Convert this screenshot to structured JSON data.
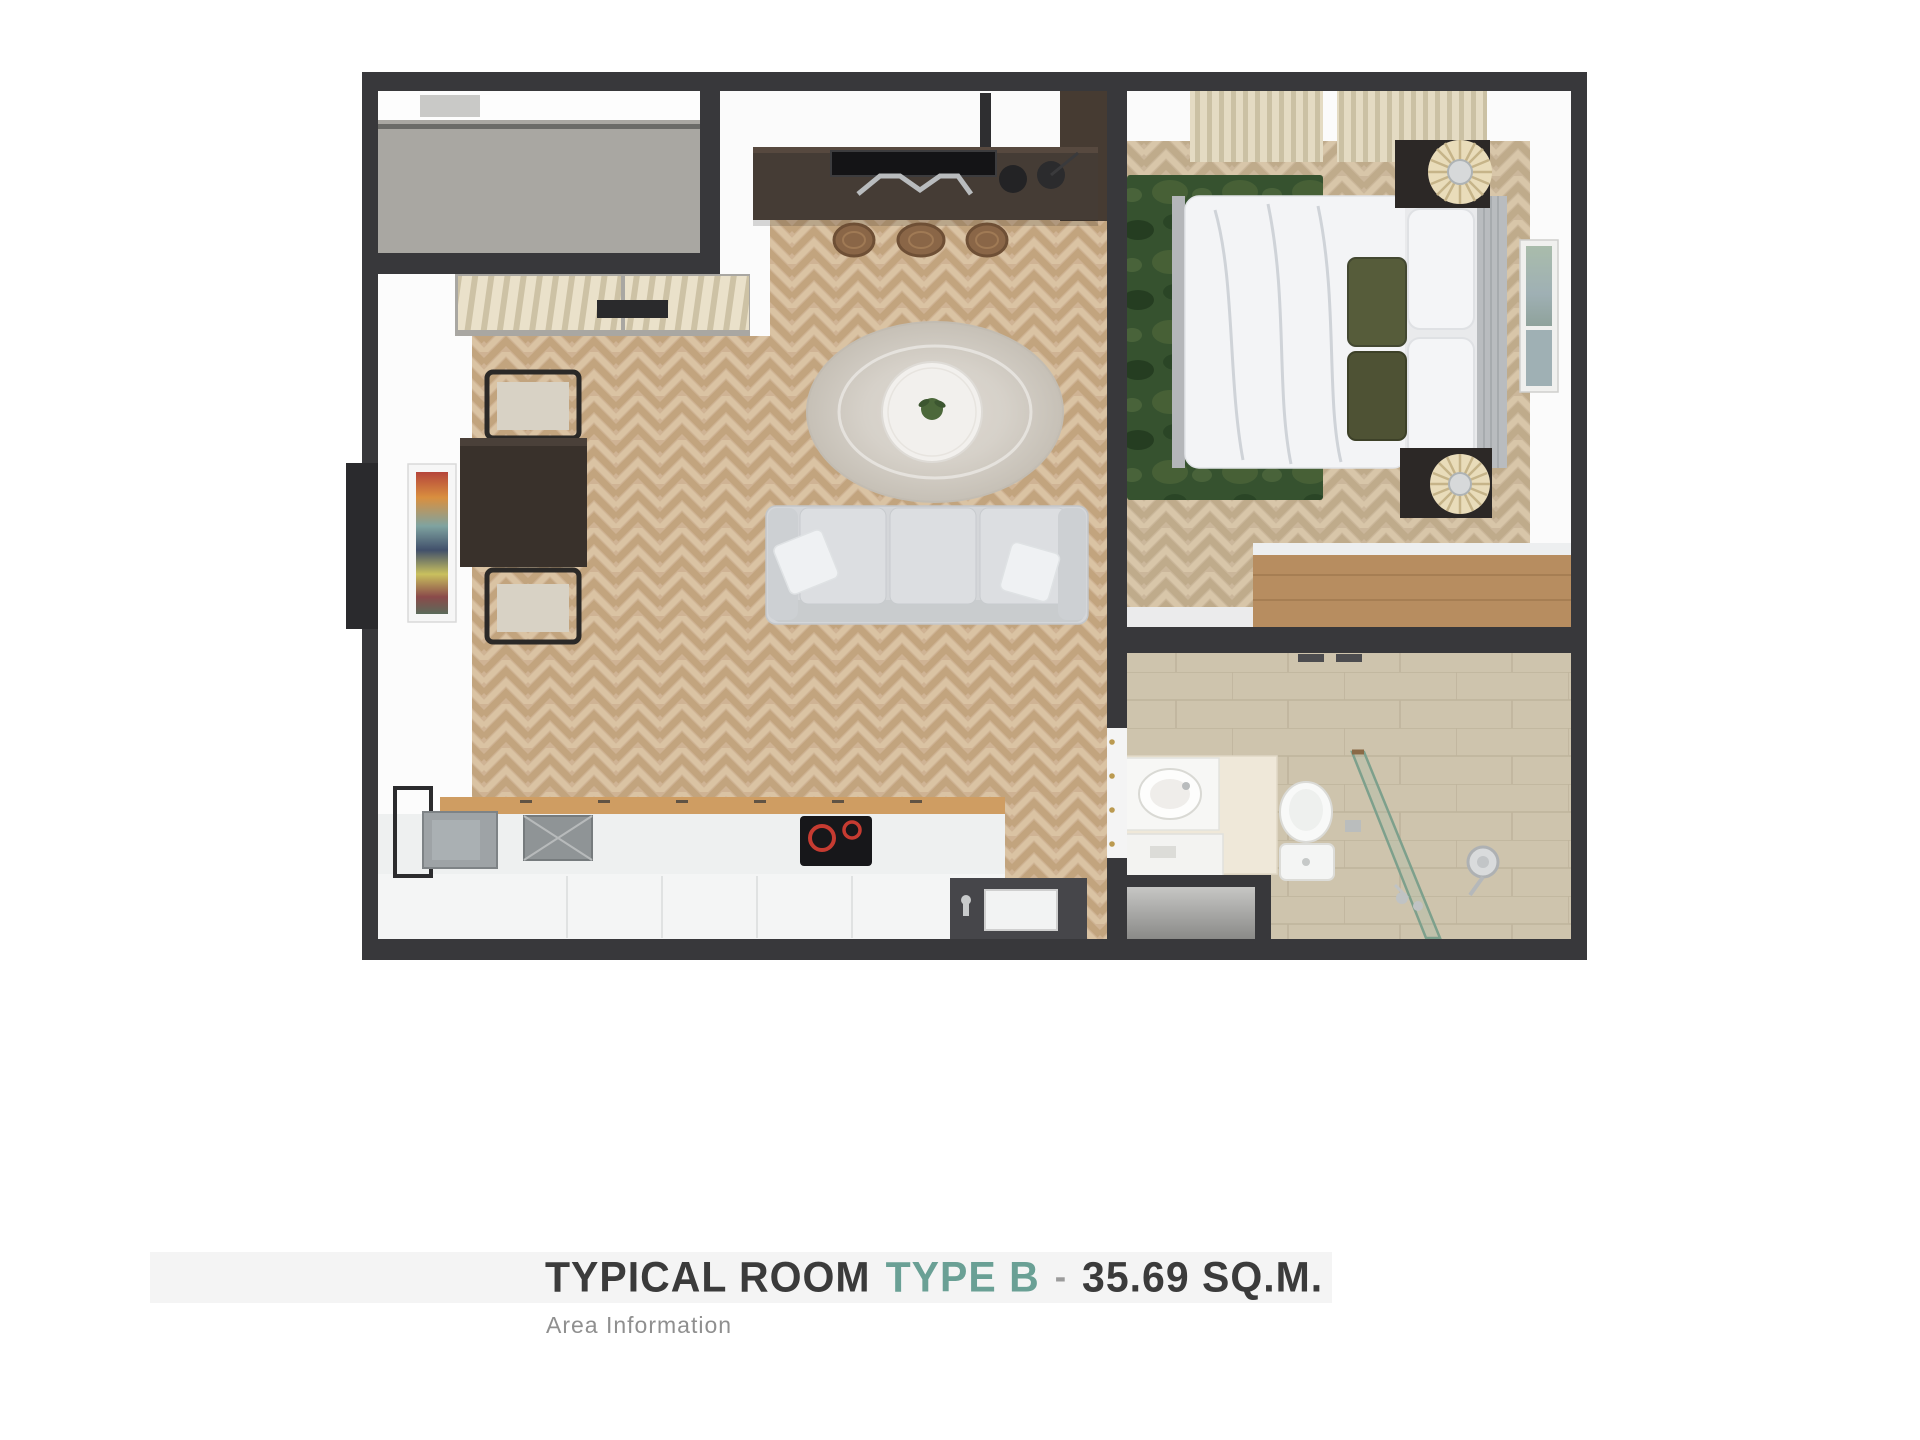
{
  "footer": {
    "title_part1": "TYPICAL ROOM",
    "title_part2": "TYPE B",
    "title_separator": "-",
    "title_part3": "35.69 SQ.M.",
    "subtitle": "Area Information",
    "band_color": "#f4f4f4",
    "title_color": "#3b3b3b",
    "accent_color": "#6aa095",
    "separator_color": "#9b9b9b",
    "subtitle_color": "#8f8f8f"
  },
  "floorplan": {
    "wall_color": "#38383b",
    "living_wood_color": "#cfb394",
    "bedroom_wood_color": "#cbb79b",
    "concrete_color": "#a9a7a2",
    "bathroom_tile_color": "#cec4ad",
    "green_rug_color": "#36522f",
    "round_rug_color": "#d3cec6",
    "sofa_color": "#d4d6d9",
    "counter_wood_color": "#cf9d62",
    "hob_ring_color": "#c63b31",
    "curtain_color": "#ded5c0",
    "rattan_lamp_color": "#e9dcba",
    "glass_color": "#7da08c",
    "dresser_wood_color": "#b78d60",
    "console_color": "#453c35",
    "hinge_color": "#bb9a50"
  }
}
